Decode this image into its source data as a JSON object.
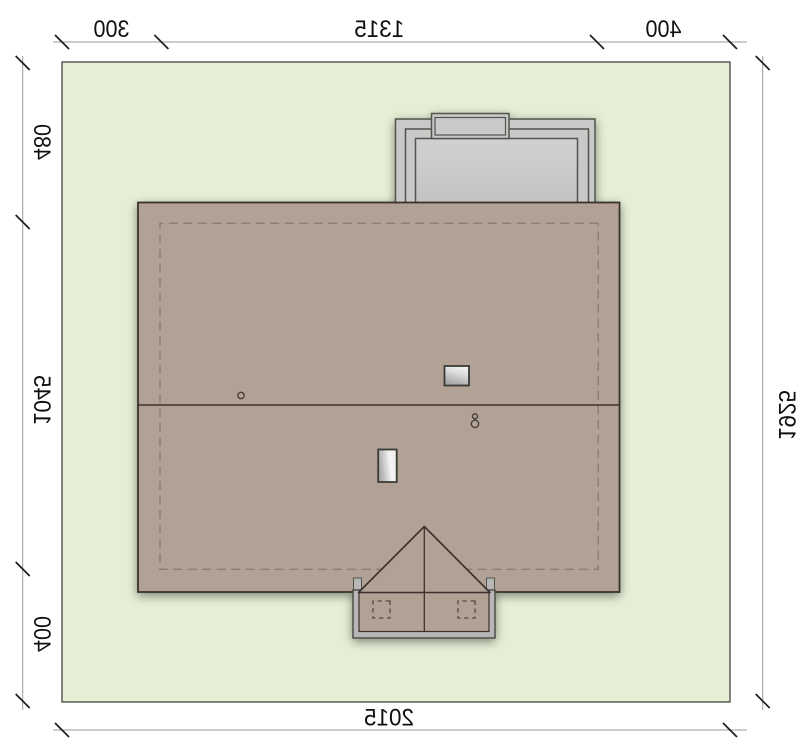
{
  "drawing": {
    "type": "house-site-plan-roof-view",
    "mirrored_print": true
  },
  "dimensions": {
    "top": [
      "300",
      "1315",
      "400"
    ],
    "left": [
      "480",
      "1045",
      "400"
    ],
    "right": [
      "1925"
    ],
    "bottom": [
      "2015"
    ]
  },
  "colors": {
    "background": "#ffffff",
    "plot_fill": "#e6efd6",
    "plot_stroke": "#44443c",
    "roof_fill": "#b2a195",
    "roof_stroke": "#3a332d",
    "eaves_dash": "#8e7d6f",
    "terrace_fill": "#c9c9c9",
    "terrace_stroke": "#51554b",
    "porch_slab_fill": "#b7b7b7",
    "glass_light": "#f6f6f6",
    "glass_dark": "#a9a9a9",
    "dim_line": "#9a9a9a",
    "dim_tick": "#1d1d1d",
    "dim_text": "#101010"
  }
}
